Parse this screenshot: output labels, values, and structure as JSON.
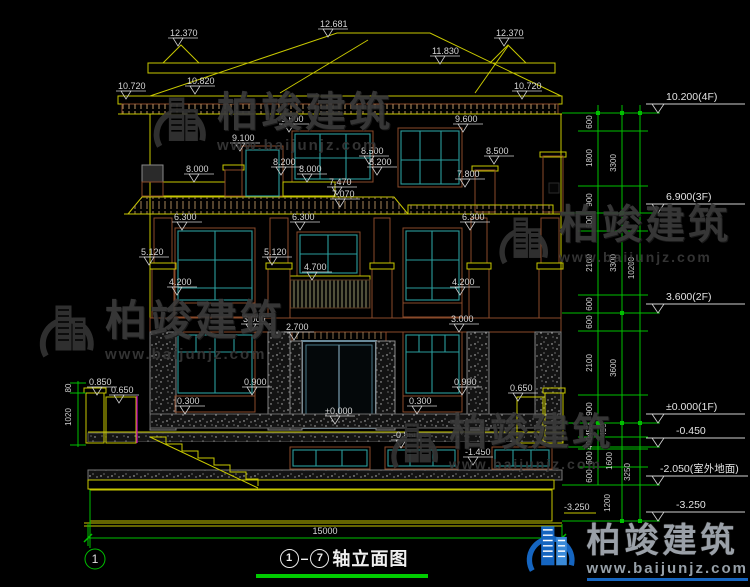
{
  "watermark": {
    "brand": "柏竣建筑",
    "url": "www.baijunjz.com"
  },
  "footer": {
    "brand": "柏竣建筑",
    "url": "www.baijunjz.com"
  },
  "title": {
    "axis_start": "1",
    "axis_end": "7",
    "text": "轴立面图"
  },
  "axis_bubble": "1",
  "overall_width": "15000",
  "colors": {
    "line_yellow": "#c8c800",
    "dim_green": "#00bf00",
    "text_white": "#d6d6d6",
    "frame_teal": "#2a9d9d",
    "band_brown": "#6b3a22",
    "logo_blue": "#1565c0",
    "magenta": "#c800c8"
  },
  "dims": {
    "roof": [
      "12.681",
      "12.370",
      "12.370",
      "11.830",
      "10.820",
      "10.720",
      "10.720"
    ],
    "floor3": [
      "9.600",
      "9.100",
      "9.600",
      "8.500",
      "8.200",
      "8.200",
      "8.000",
      "8.000",
      "8.500",
      "7.800",
      "7.470",
      "7.070"
    ],
    "floor2": [
      "6.300",
      "6.300",
      "6.300",
      "5.120",
      "5.120",
      "4.700",
      "4.200",
      "4.200"
    ],
    "floor1": [
      "3.000",
      "3.000",
      "2.700",
      "0.900",
      "0.900",
      "0.300",
      "0.300",
      "±0.000"
    ],
    "site": [
      "0.850",
      "0.650",
      "0.650",
      "-0.850",
      "-1.450",
      "-3.250"
    ]
  },
  "right_markers": [
    "10.200(4F)",
    "6.900(3F)",
    "3.600(2F)",
    "±0.000(1F)",
    "-0.450",
    "-2.050(室外地面)",
    "-3.250"
  ],
  "right_col1": [
    "600",
    "1800",
    "900",
    "600",
    "2100",
    "600",
    "600",
    "2100",
    "900",
    "450",
    "400",
    "600",
    "600"
  ],
  "right_col2": [
    "3300",
    "3300",
    "3600",
    "450",
    "1600",
    "1200"
  ],
  "right_col3": [
    "10200",
    "3250"
  ],
  "left_dims": [
    "80",
    "1020"
  ]
}
